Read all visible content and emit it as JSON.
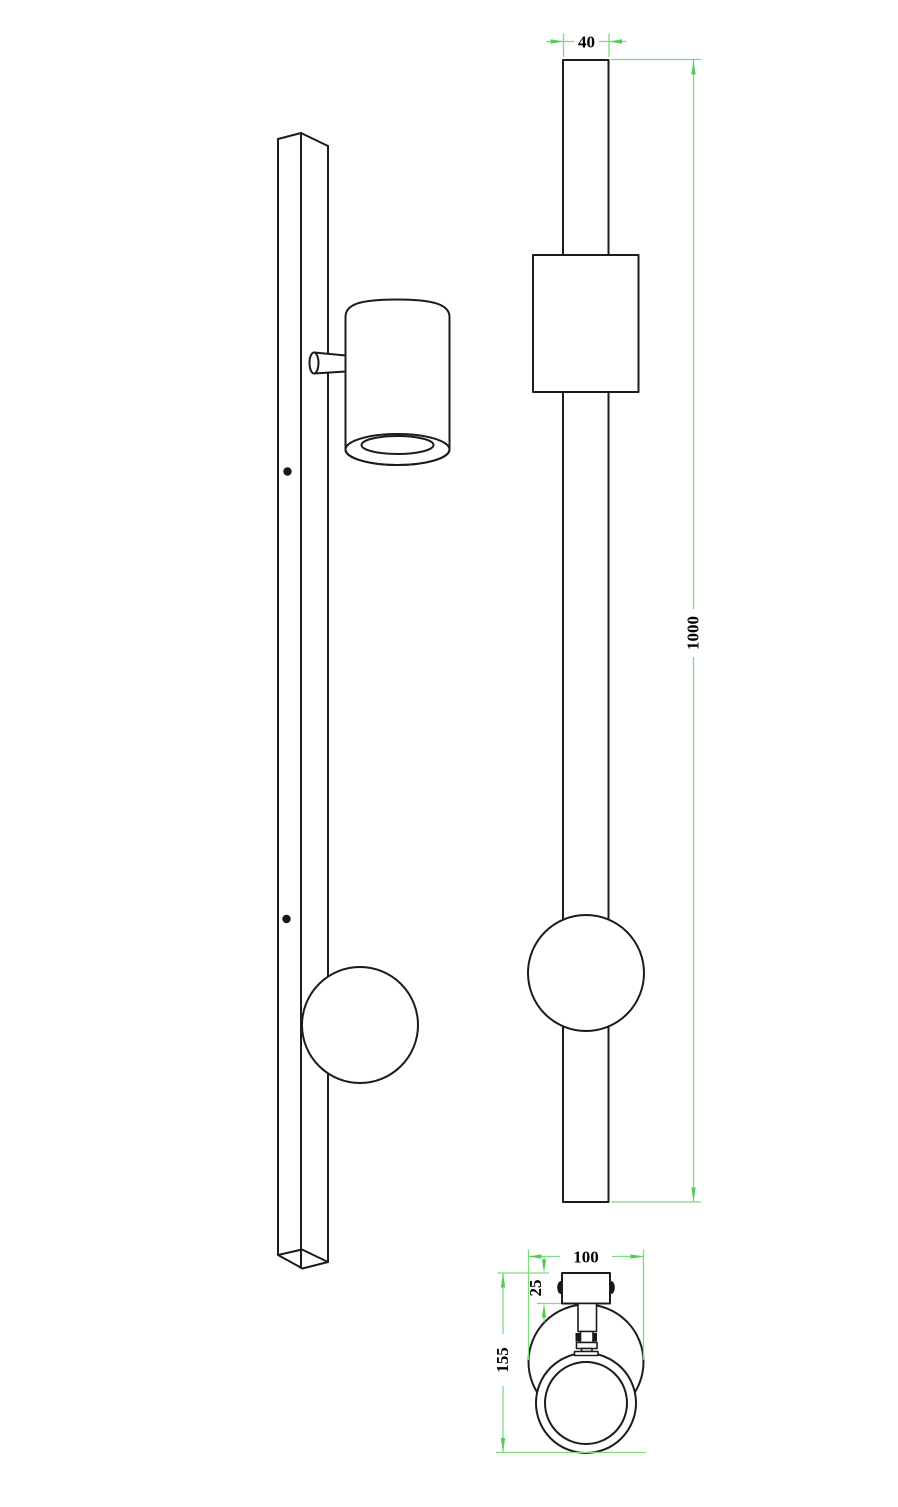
{
  "drawing": {
    "title": "wall-bar-spotlight-technical-drawing",
    "units_shown": "mm",
    "colors": {
      "background": "#ffffff",
      "object_line": "#1c1c1c",
      "dimension_line": "#7edc7e",
      "dimension_arrow": "#55cc55",
      "dimension_text": "#000000"
    },
    "dimensions": {
      "bar_width": "40",
      "bar_length": "1000",
      "head_width": "100",
      "bar_depth": "25",
      "projection_depth": "155"
    }
  }
}
